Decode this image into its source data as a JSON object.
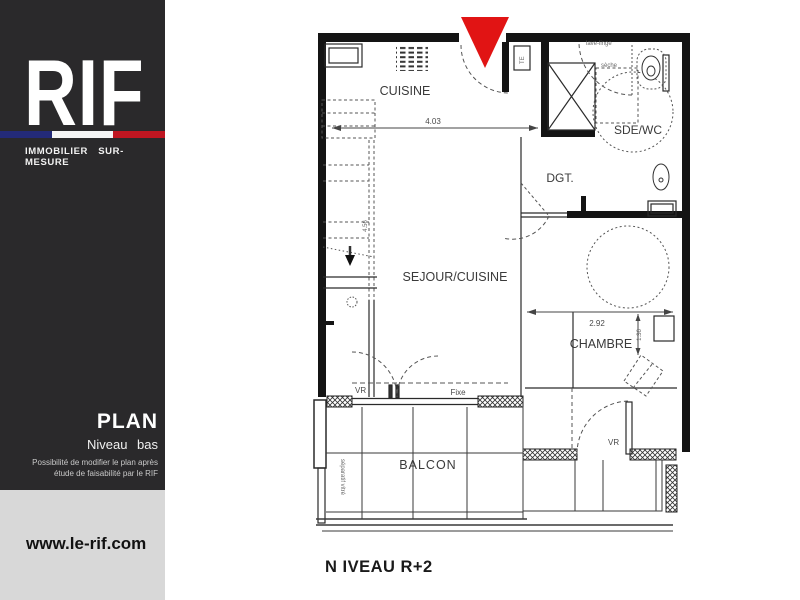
{
  "sidebar": {
    "logo": "RIF",
    "tagline": "IMMOBILIER SUR-MESURE",
    "plan_label": "PLAN",
    "plan_sublabel": "Niveau bas",
    "disclaimer1": "Possibilité de modifier le plan après",
    "disclaimer2": "étude de faisabilité par le RIF",
    "website": "www.le-rif.com",
    "colors": {
      "panel": "#2a292b",
      "footer": "#d8d8d8",
      "flag_blue": "#232a78",
      "flag_white": "#f5f5f5",
      "flag_red": "#bf1621"
    }
  },
  "plan": {
    "caption": "N IVEAU R+2",
    "rooms": {
      "cuisine": "CUISINE",
      "sde_wc": "SDE/WC",
      "dgt": "DGT.",
      "sejour": "SEJOUR/CUISINE",
      "chambre": "CHAMBRE",
      "balcon": "BALCON"
    },
    "dims": {
      "sejour_width": "4.03",
      "chambre_width": "2.92",
      "chambre_depth": "1.36",
      "stair": "4.56"
    },
    "labels": {
      "vr_window": "VR",
      "fixed_window": "Fixe",
      "vr_door": "VR",
      "glass_divider": "séparatif vitré",
      "electrical": "TE",
      "washer": "lave-linge",
      "dryer": "sèche"
    },
    "entry_marker_color": "#e11414"
  }
}
